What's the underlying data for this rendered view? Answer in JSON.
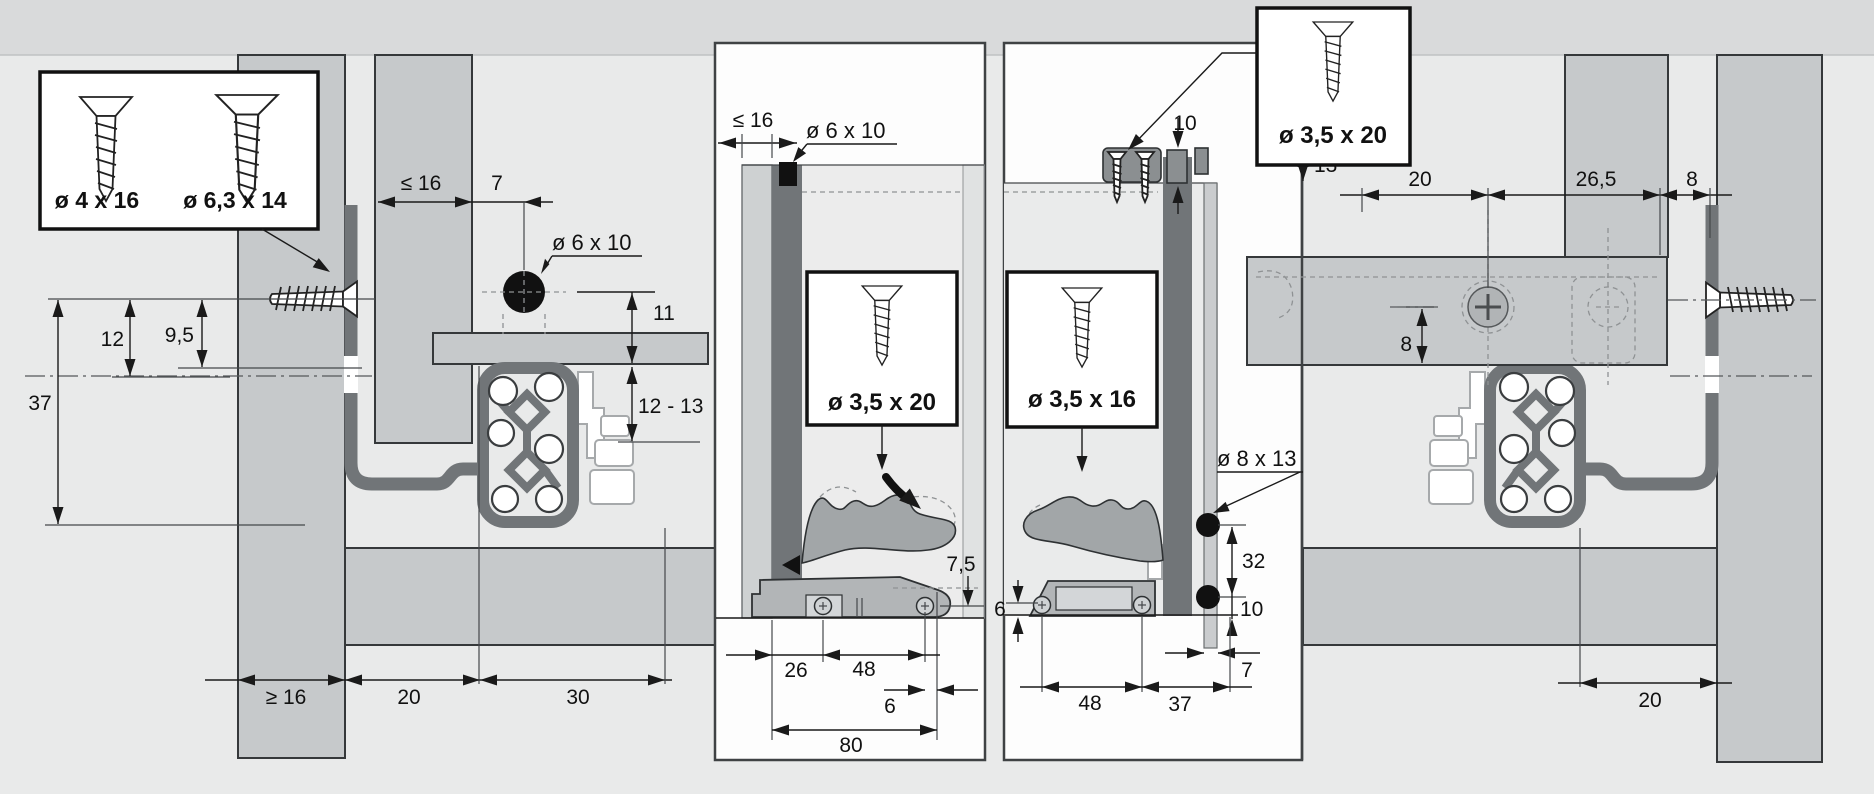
{
  "diagram": {
    "type": "drawer-runner-installation-drawing",
    "colors": {
      "background": "#e9eaea",
      "top_band": "#d9dadb",
      "board_gray": "#c6c9cb",
      "rail_dark": "#717578",
      "hole_black": "#111111"
    },
    "legend": {
      "screw_small": "ø 4 x 16",
      "screw_large": "ø 6,3 x 14"
    },
    "left_view": {
      "dim_depth_max": "≤ 16",
      "dim_7": "7",
      "hole": "ø 6 x 10",
      "dim_11": "11",
      "dim_12_13": "12 - 13",
      "dim_12": "12",
      "dim_9_5": "9,5",
      "dim_37": "37",
      "dim_min16": "≥ 16",
      "dim_20": "20",
      "dim_30": "30"
    },
    "panel_front": {
      "dim_thickness": "≤ 16",
      "plug": "ø 6 x 10",
      "screw": "ø 3,5 x 20",
      "dim_7_5": "7,5",
      "dim_26": "26",
      "dim_48": "48",
      "dim_6": "6",
      "dim_80": "80"
    },
    "panel_rear": {
      "dim_10_top": "10",
      "dim_13": "13",
      "screw_top": "ø 3,5 x 20",
      "screw": "ø 3,5 x 16",
      "hole": "ø 8 x 13",
      "dim_32": "32",
      "dim_10_right": "10",
      "dim_6": "6",
      "dim_48": "48",
      "dim_37": "37",
      "dim_7": "7"
    },
    "right_view": {
      "dim_20_top": "20",
      "dim_26_5": "26,5",
      "dim_8_top": "8",
      "dim_8_mid": "8",
      "dim_20_bottom": "20"
    }
  }
}
